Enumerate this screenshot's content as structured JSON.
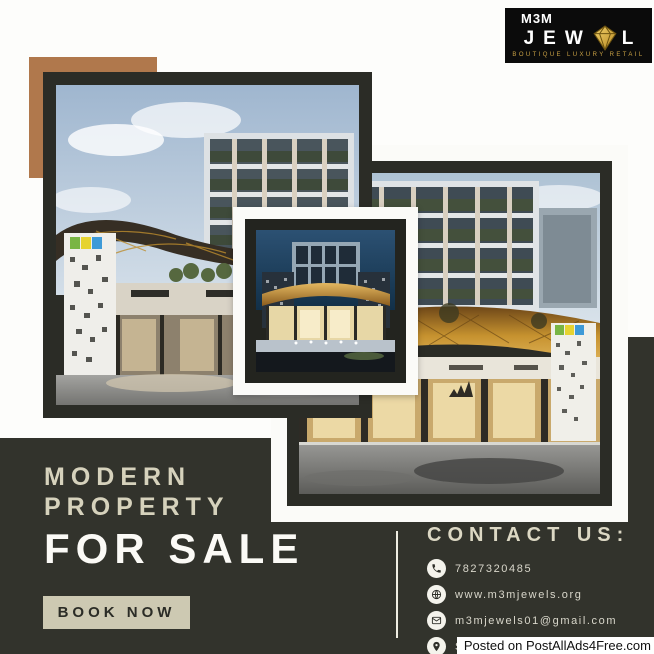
{
  "logo": {
    "top": "M3M",
    "word_start": "JEW",
    "word_end": "L",
    "tagline": "BOUTIQUE LUXURY RETAIL"
  },
  "headline": {
    "line1": "MODERN",
    "line2": "PROPERTY",
    "line3": "FOR SALE"
  },
  "cta": {
    "label": "BOOK NOW"
  },
  "contact": {
    "heading": "CONTACT US:",
    "items": [
      {
        "icon": "phone-icon",
        "label": "7827320485"
      },
      {
        "icon": "globe-icon",
        "label": "www.m3mjewels.org"
      },
      {
        "icon": "mail-icon",
        "label": "m3mjewels01@gmail.com"
      },
      {
        "icon": "location-icon",
        "label": "Sector 25 Gurgaon Haryana"
      }
    ]
  },
  "watermark": {
    "text": "Posted on PostAllAds4Free.com"
  },
  "colors": {
    "panel_dark": "#32332c",
    "frame_dark": "#2b2c26",
    "cream": "#d6d2bc",
    "button_bg": "#cdc9b2",
    "brown_square": "#b0784c",
    "logo_gold": "#c9a144",
    "white": "#fbfaf6"
  }
}
